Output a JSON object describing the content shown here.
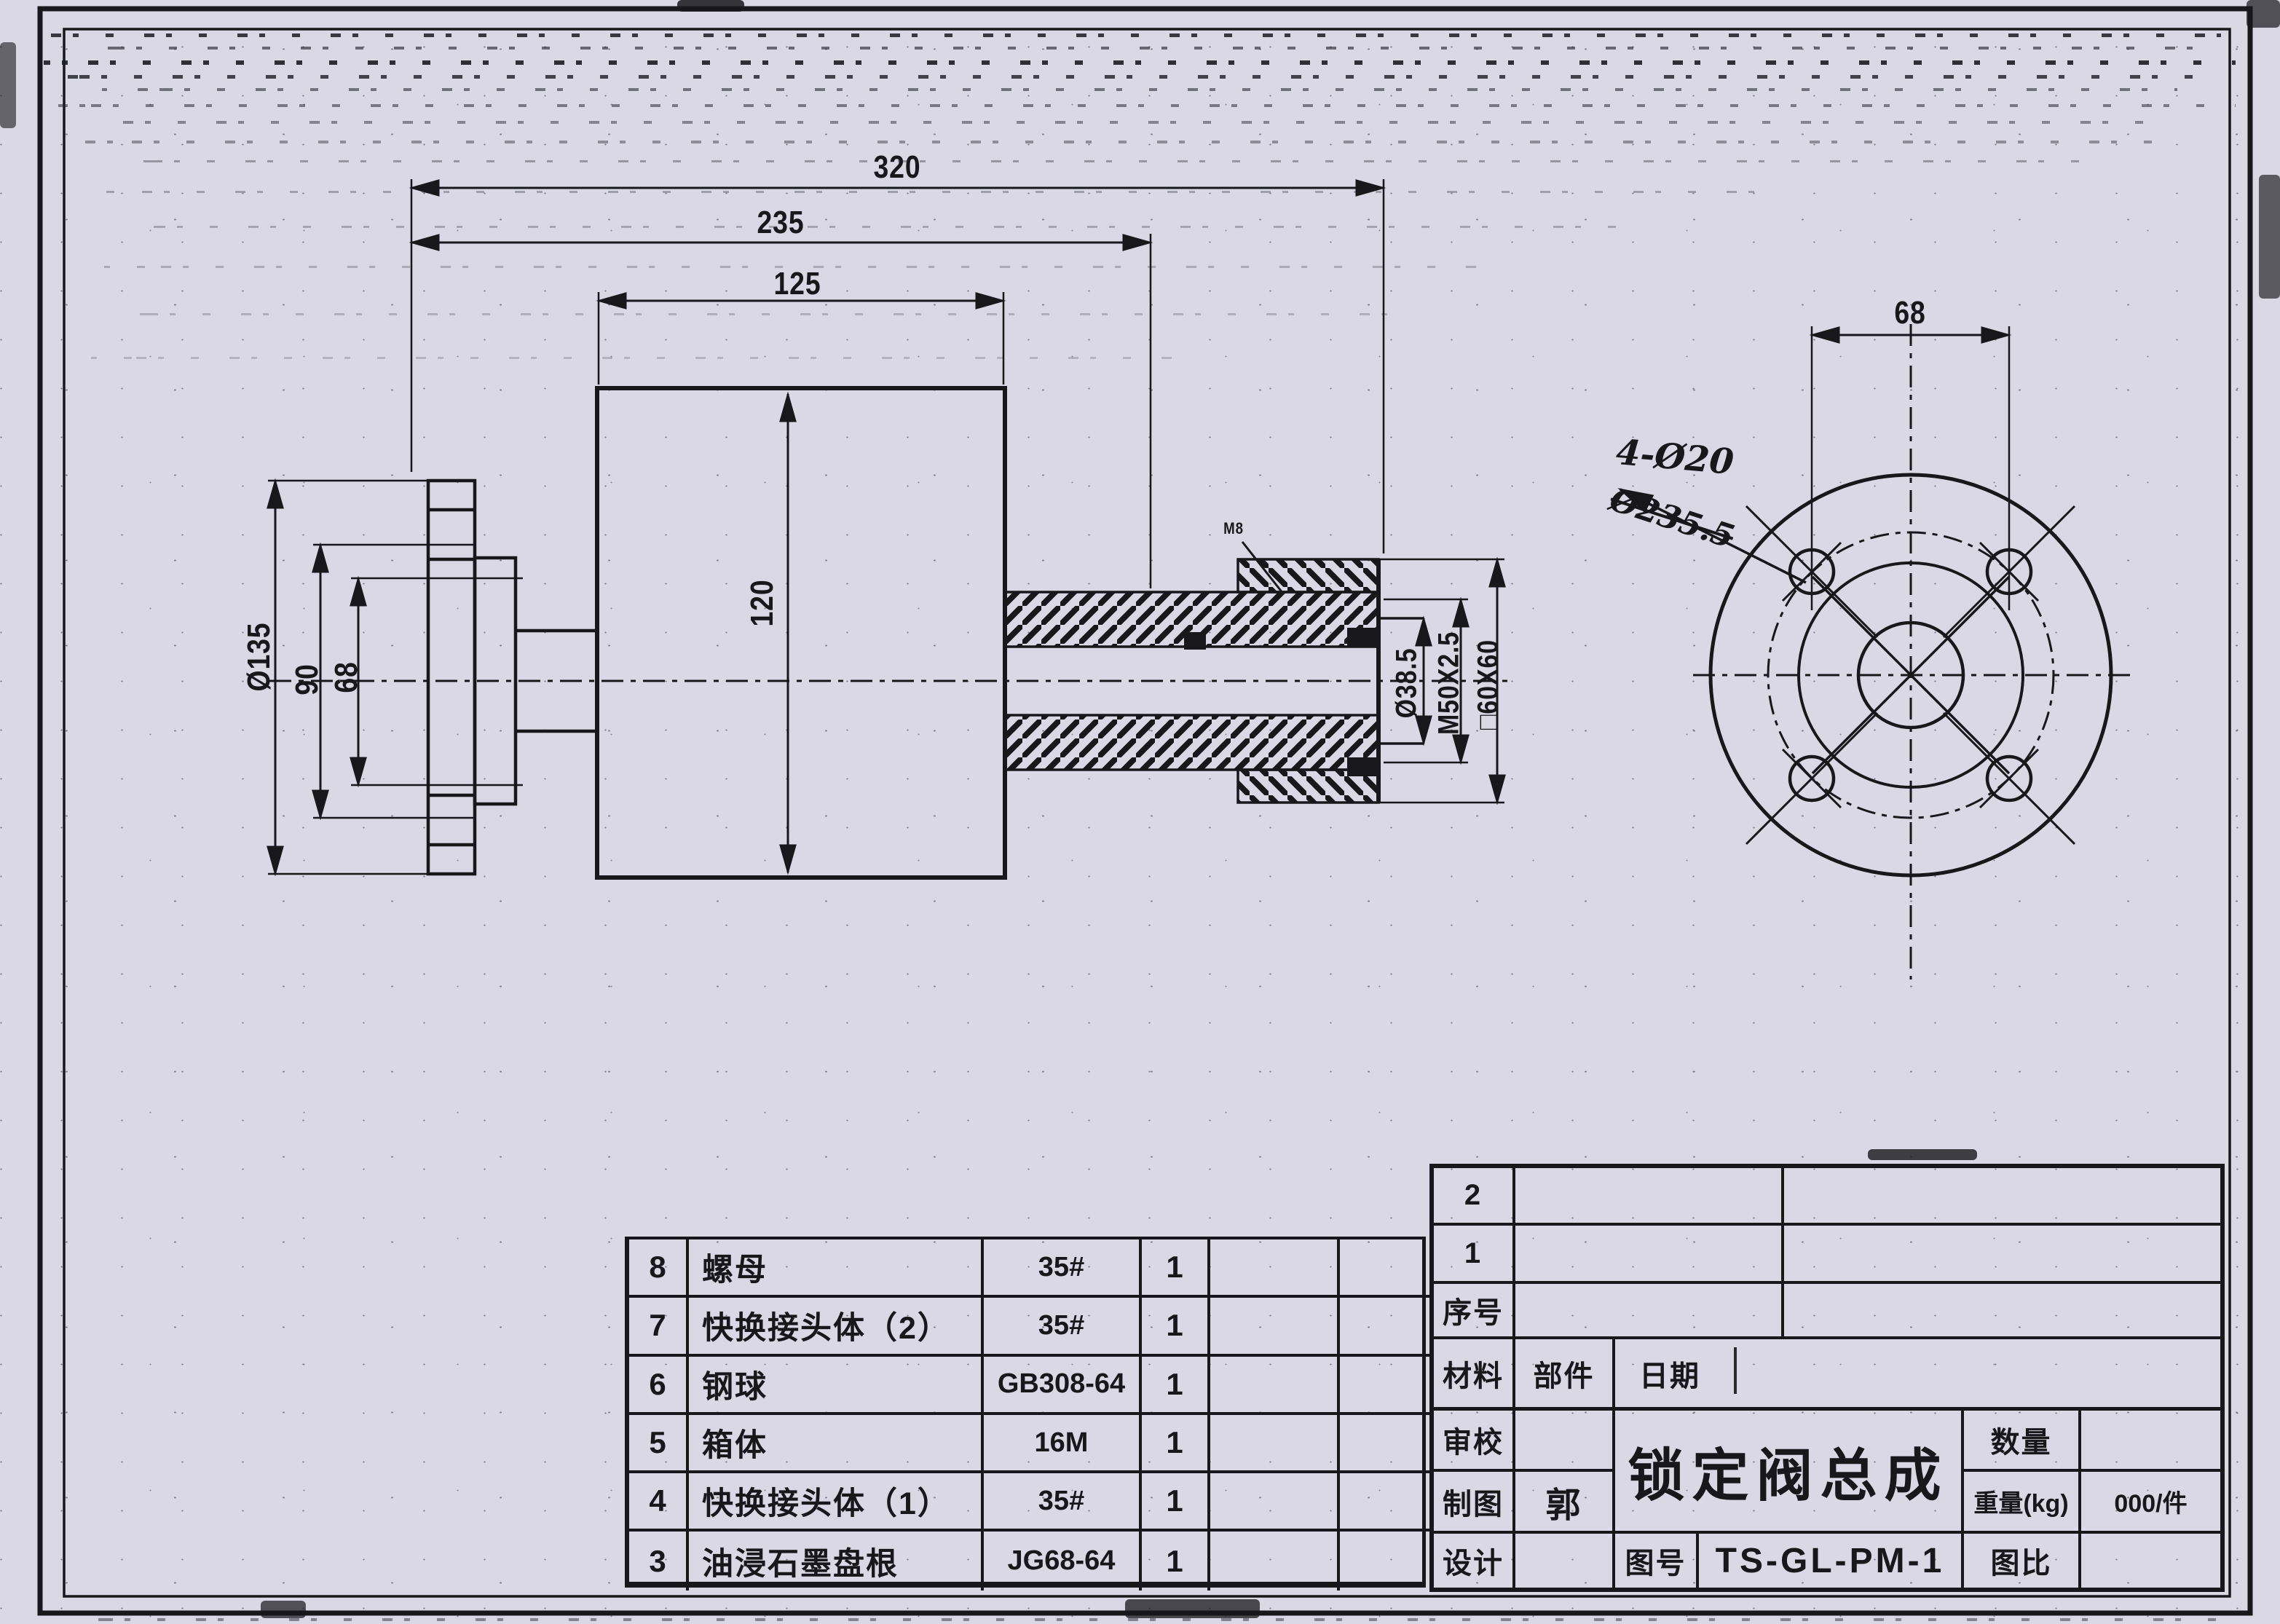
{
  "colors": {
    "paper": "#d9d8e4",
    "ink": "#17171c"
  },
  "main_view": {
    "dims": {
      "overall_length": "320",
      "mid_length": "235",
      "body_width": "125",
      "body_height": "120",
      "flange_od": "Ø135",
      "flange_mid": "90",
      "flange_bore": "68",
      "stub_bore": "Ø38.5",
      "thread_spec": "M50X2.5",
      "square_section": "□60X60",
      "leader_note": "M8"
    }
  },
  "end_view": {
    "dims": {
      "hole_spacing": "68"
    },
    "notes": {
      "holes": "4-Ø20",
      "struck_value": "Ø235.5"
    }
  },
  "parts_table": {
    "rows": [
      {
        "no": "8",
        "name": "螺母",
        "spec": "35#",
        "qty": "1"
      },
      {
        "no": "7",
        "name": "快换接头体（2）",
        "spec": "35#",
        "qty": "1"
      },
      {
        "no": "6",
        "name": "钢球",
        "spec": "GB308-64",
        "qty": "1"
      },
      {
        "no": "5",
        "name": "箱体",
        "spec": "16M",
        "qty": "1"
      },
      {
        "no": "4",
        "name": "快换接头体（1）",
        "spec": "35#",
        "qty": "1"
      },
      {
        "no": "3",
        "name": "油浸石墨盘根",
        "spec": "JG68-64",
        "qty": "1"
      }
    ]
  },
  "title_block": {
    "row_2": "2",
    "row_1": "1",
    "serial_label": "序号",
    "material_label": "材料",
    "part_label": "部件",
    "date_label": "日期",
    "review_label": "审校",
    "draft_label": "制图",
    "draft_value": "郭",
    "design_label": "设计",
    "drawing_title": "锁定阀总成",
    "drawing_no_label": "图号",
    "drawing_no_value": "TS-GL-PM-1",
    "qty_label": "数量",
    "weight_label": "重量(kg)",
    "weight_value": "000/件",
    "scale_label": "图比"
  }
}
